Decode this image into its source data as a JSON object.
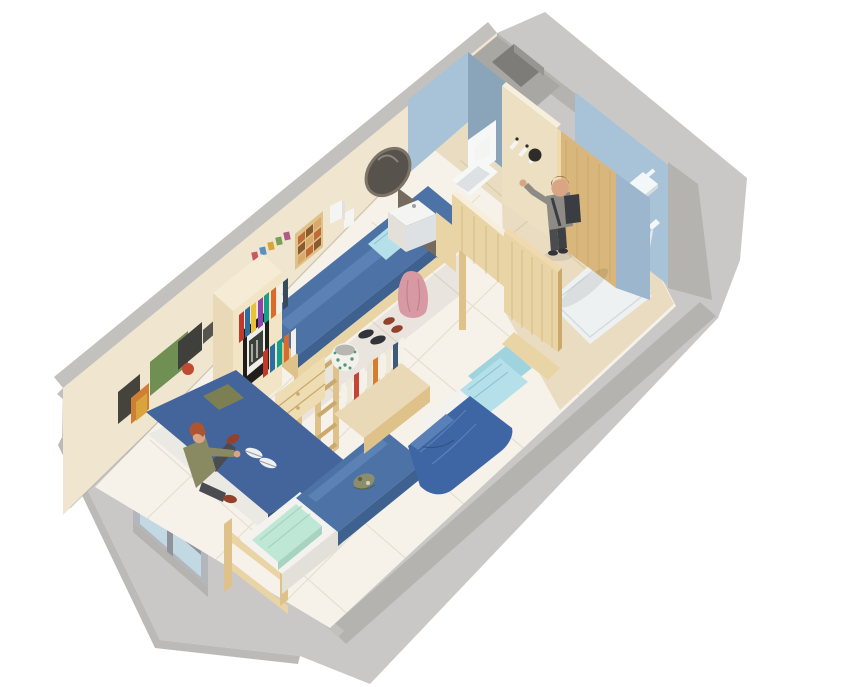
{
  "scene": {
    "description": "3D isometric cutaway rendering of a student dorm suite: shared bedroom with loft bed, two single beds, daybed with seated person, wooden storage units, and a bathroom block with toilet room, vanity with oval mirror, entry door with person walking in, and a walk-in shower",
    "background": "#ffffff",
    "type": "3d-isometric-floorplan"
  },
  "rooms": [
    {
      "id": "bedroom",
      "label": "Shared bedroom / living area"
    },
    {
      "id": "toilet-room",
      "label": "Toilet room"
    },
    {
      "id": "entry-hall",
      "label": "Entry hall"
    },
    {
      "id": "shower-room",
      "label": "Walk-in shower"
    }
  ],
  "objects": [
    {
      "id": "window",
      "label": "Aluminium-framed window in end wall"
    },
    {
      "id": "daybed",
      "label": "Blue daybed with green cushion"
    },
    {
      "id": "loft-bed",
      "label": "Wooden loft bed with blue mattress and ladder"
    },
    {
      "id": "storage-unit",
      "label": "Wooden storage unit with bookshelf, framed picture and drawers"
    },
    {
      "id": "bed-2",
      "label": "Single bed with blue mattress, white sheet and mint blanket"
    },
    {
      "id": "bed-3",
      "label": "Single bed with blue duvet and two light-blue pillows"
    },
    {
      "id": "headboard-shelf",
      "label": "Headboard bookshelf"
    },
    {
      "id": "laundry-basket",
      "label": "Patterned laundry basket"
    },
    {
      "id": "vanity",
      "label": "White sink unit with oval mirror"
    },
    {
      "id": "toilet",
      "label": "Wall-hung toilet with privacy screen"
    },
    {
      "id": "entry-door",
      "label": "Open wooden entry door with coat hooks"
    },
    {
      "id": "sliding-door",
      "label": "Wooden sliding bathroom door"
    },
    {
      "id": "shower",
      "label": "Rain shower head, hand shower and white tray"
    },
    {
      "id": "utility-shaft",
      "label": "Concrete utility shaft"
    }
  ],
  "people": [
    {
      "id": "person-sitting",
      "label": "Person with ginger hair in olive shirt sitting on daybed"
    },
    {
      "id": "person-standing",
      "label": "Person in gray sweater with backpack entering through door"
    }
  ],
  "palette": {
    "bg": "#ffffff",
    "slabSide": "#c9c8c6",
    "slabSideDark": "#bbbab8",
    "slabRim": "#b5b3af",
    "slabRimLight": "#c3c1bd",
    "wallCream": "#f0e5cf",
    "wallCreamDeep": "#e4d3b4",
    "wallPartition": "#ecdfc2",
    "wallPartitionTop": "#f7efdc",
    "floorMain": "#f6f2ea",
    "floorLine": "#e6dfd1",
    "floorBath": "#e9dcc1",
    "floorBathLine": "#dbcda9",
    "trayWhite": "#eef1f2",
    "trayLine": "#d5dcdf",
    "bathWallLight": "#a8c3d7",
    "bathWallMid": "#9cb7cd",
    "bathWallSlate": "#8aa5ba",
    "nicheDark": "#7e7c78",
    "nicheMid": "#989693",
    "nicheTop": "#a9a7a3",
    "woodLight": "#e9d4a6",
    "woodMid": "#dfc289",
    "woodDark": "#c9a96c",
    "woodDoor": "#d8b67c",
    "woodDoorGrain": "#c59f63",
    "woodPanelTop": "#f0d9ae",
    "drawerWood": "#eedcb2",
    "unitFront": "#f2e5c6",
    "unitSide": "#e9d9b6",
    "unitTop": "#f6ecd6",
    "bedBlue": "#4c72a6",
    "bedBlueHi": "#5b81b5",
    "bedBlueSide": "#3f618f",
    "sofaBlue": "#43659c",
    "sofaBlueSide": "#35527f",
    "duvetBlue": "#3e66a4",
    "duvetFold": "#5a80b8",
    "duvetCrease": "#32538a",
    "pillowBlue": "#b5e0ea",
    "pillowBlueDeep": "#9fd4de",
    "pillowCrease": "#8ec6d2",
    "mint": "#bfe7d6",
    "mintShade": "#a6d4c0",
    "sheetWhite": "#f3f2ee",
    "sheetShade": "#e2e0d8",
    "baseWhite": "#ebe9e3",
    "toiletWhite": "#f6f7f7",
    "toiletShade": "#dde1e3",
    "mirrorGlass": "#57524b",
    "mirrorRim": "#7d7468",
    "alcoveDark": "#746b5e",
    "windowFrame": "#b3b7bb",
    "windowFrameDark": "#90949a",
    "windowGlass": "#d3e6ee",
    "windowGlassLow": "#c2d8e2",
    "glassStreak": "#eef6f9",
    "skin": "#d9a584",
    "hairGinger": "#ad5530",
    "hairBrown": "#6b4126",
    "shirtOlive": "#8a8a62",
    "sweaterGray": "#8e8b85",
    "sweaterShade": "#7b7872",
    "pantsDark": "#4b4c50",
    "pantsDark2": "#3e3f43",
    "backpack": "#3a3d42",
    "shoeBrown": "#94412b",
    "shoeDark": "#33343a",
    "sneakerWhite": "#eff0f2",
    "sneakerSole": "#9aa0a8",
    "robePink": "#d79aa4",
    "robeShade": "#c3808d",
    "cushionGreen": "#7b7f52",
    "capCamo": "#8a8f6a",
    "capCamoDark": "#5e6248",
    "capCamoLight": "#d6d2c2",
    "basketWhite": "#f2f1ec",
    "basketGreen": "#4e9b7a",
    "basketInner": "#b8b6b0",
    "frameBlack": "#201e1c",
    "matteWhite": "#f0eee8",
    "photoDark": "#3a3f3a",
    "hookWhite": "#f4f4f2",
    "capBlack": "#2e2c29",
    "fixtureWhite": "#f4f7f8",
    "hose": "#dfe7ea",
    "shadow": "rgba(0,0,0,0.08)",
    "shadowSoft": "rgba(0,0,0,0.05)",
    "shadowDeep": "rgba(0,0,0,0.14)"
  },
  "poster_colors": [
    "#44443c",
    "#cf7f35",
    "#6f8f53",
    "#3f3f3b",
    "#bf4b32",
    "#55544e",
    "#d9a43a"
  ],
  "bunting_colors": [
    "#c45a64",
    "#5a8fc0",
    "#d9a43a",
    "#7aa055",
    "#b05a8a"
  ],
  "grid_colors": [
    "#c06a38",
    "#8a5a30",
    "#daa96a"
  ],
  "books_unit_colors": [
    "#c0392b",
    "#2e6da4",
    "#e8c23a",
    "#8e44ad",
    "#17a089",
    "#d96c2c",
    "#f2f0ea",
    "#384a5e",
    "#c0392b",
    "#2e6da4",
    "#17a089",
    "#d96c2c",
    "#f2f0ea"
  ],
  "books_headboard_colors": [
    "#f4f1e8",
    "#efe9da",
    "#c44536",
    "#f4f1e8",
    "#e8e2d2",
    "#d97c2e",
    "#f4f1e8",
    "#eee8d8",
    "#3e5a78",
    "#f4f1e8"
  ]
}
